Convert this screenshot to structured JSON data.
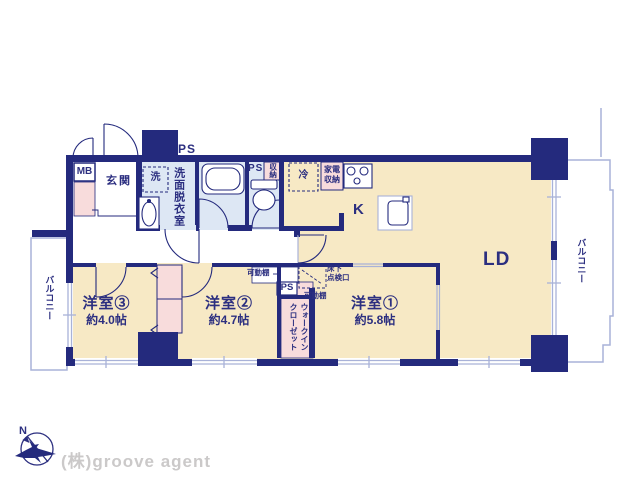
{
  "plan": {
    "entrance": "玄関",
    "mb": "MB",
    "ps_top": "PS",
    "washer": "洗",
    "washroom": "洗面脱衣室",
    "ps_toilet": "PS",
    "toilet_storage": "収納",
    "fridge": "冷",
    "appliance_storage": "家電\n収納",
    "kitchen": "K",
    "living_dining": "LD",
    "balcony_left": "バルコニー",
    "balcony_right": "バルコニー",
    "shelf_corridor": "可動棚",
    "shelf_room1": "可動棚",
    "floor_hatch": "床下\n点検口",
    "ps_wic": "PS",
    "wic": "ウォークイン\nクローゼット",
    "room1_name": "洋室①",
    "room1_size": "約5.8帖",
    "room2_name": "洋室②",
    "room2_size": "約4.7帖",
    "room3_name": "洋室③",
    "room3_size": "約4.0帖"
  },
  "footer": {
    "company": "(株)groove agent",
    "compass_north": "N"
  },
  "colors": {
    "wall_navy": "#242a7d",
    "floor_beige": "#f7e9c5",
    "sanitary_blue": "#dde7f4",
    "closet_pink": "#f8dcdc",
    "window_line": "#a9b2d8",
    "label_navy": "#2c2f80",
    "footer_gray": "#cbc9c9"
  }
}
